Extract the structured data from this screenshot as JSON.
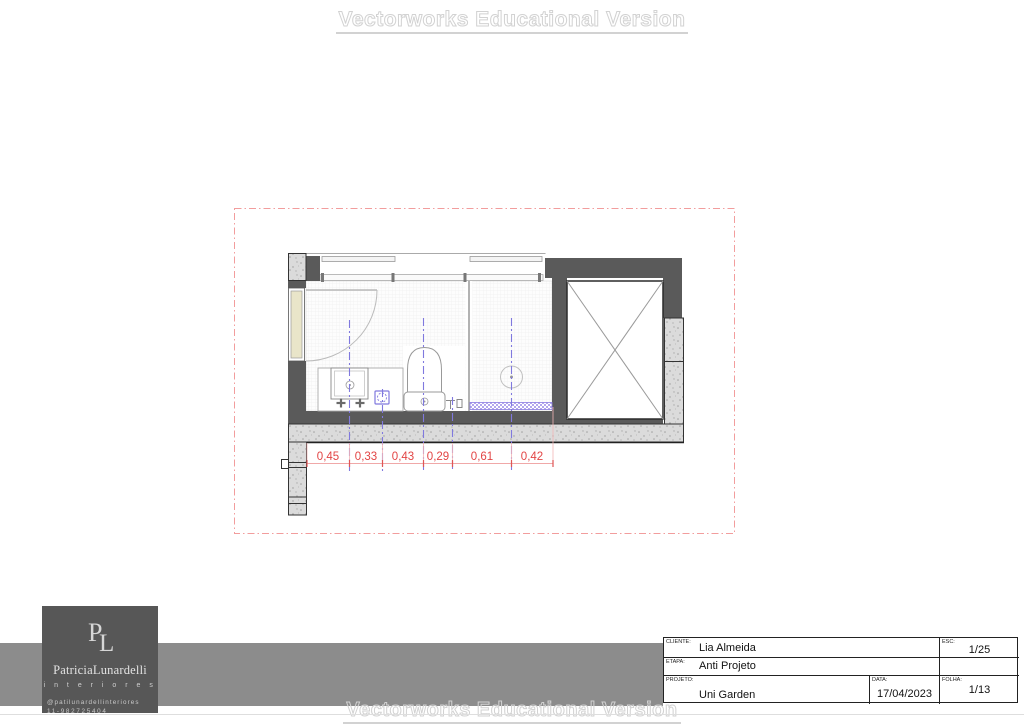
{
  "watermark": {
    "text": "Vectorworks Educational Version"
  },
  "logo": {
    "monogram_p": "P",
    "monogram_l": "L",
    "name": "PatriciaLunardelli",
    "subtitle": "i n t e r i o r e s",
    "instagram": "@patilunardellinteriores",
    "phone": "11-982725404"
  },
  "title_block": {
    "cliente_label": "CLIENTE:",
    "cliente": "Lia Almeida",
    "etapa_label": "ETAPA:",
    "etapa": "Anti Projeto",
    "projeto_label": "PROJETO:",
    "projeto": "Uni Garden",
    "esc_label": "ESC:",
    "esc": "1/25",
    "data_label": "DATA:",
    "data": "17/04/2023",
    "folha_label": "FOLHA:",
    "folha": "1/13"
  },
  "plan": {
    "dimensions": [
      "0,45",
      "0,33",
      "0,43",
      "0,29",
      "0,61",
      "0,42"
    ]
  },
  "colors": {
    "dimension_red": "#e24444",
    "centerline_blue": "#8079de",
    "wall_gray": "#5a5a5a",
    "concrete_gray": "#dbdbdb",
    "door_cream": "#e9e5c9",
    "border_pink": "#f29d9d",
    "footer_band_gray": "#8c8c8c",
    "logo_bg": "#575757"
  }
}
